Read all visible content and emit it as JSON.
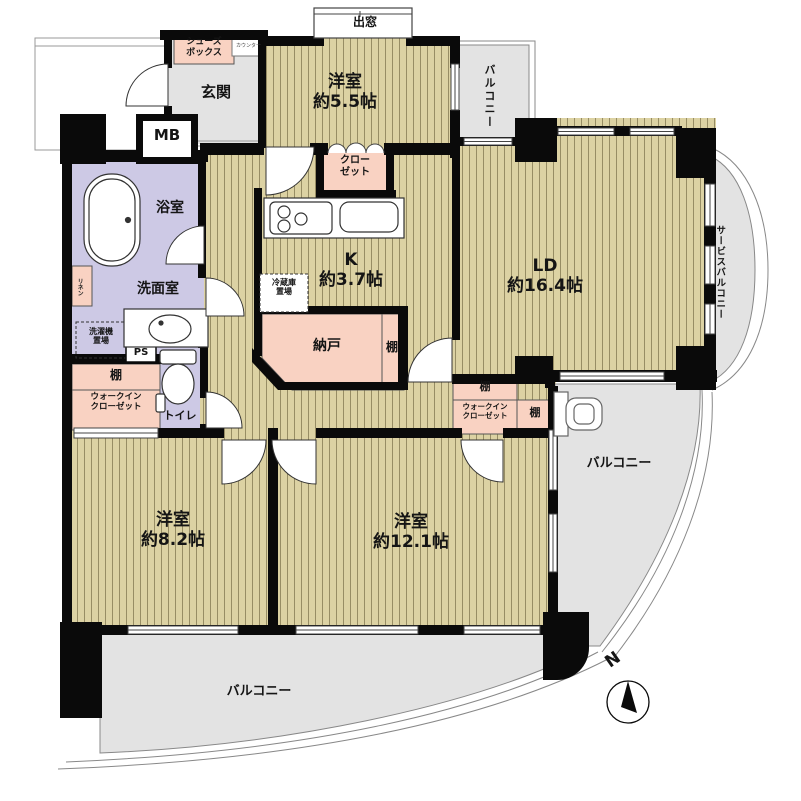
{
  "plan": {
    "title": "マンション間取り図 4LDK",
    "compass": {
      "north_label": "N"
    },
    "palette": {
      "floor": "#dcd2a3",
      "floor_line": "#978d64",
      "wall": "#0a0a0a",
      "wet_room": "#cdc9e5",
      "storage_pink": "#f9d2c2",
      "hard_gray": "#e3e3e3",
      "outline_gray": "#888888"
    },
    "rooms": {
      "entrance": {
        "label": "玄関"
      },
      "shoes_box": {
        "line1": "シューズ",
        "line2": "ボックス"
      },
      "counter": {
        "label": "カウンター"
      },
      "meter_box": {
        "label": "MB"
      },
      "bay_window": {
        "label": "出窓"
      },
      "bedroom_55": {
        "name": "洋室",
        "size": "約5.5帖"
      },
      "balcony_top": {
        "label": "バルコニー"
      },
      "closet": {
        "line1": "クロー",
        "line2": "ゼット"
      },
      "living_dining": {
        "name": "LD",
        "size": "約16.4帖"
      },
      "service_balcony": {
        "label": "サービスバルコニー"
      },
      "kitchen": {
        "name": "K",
        "size": "約3.7帖"
      },
      "fridge_space": {
        "line1": "冷蔵庫",
        "line2": "置場"
      },
      "storage_room": {
        "label": "納戸"
      },
      "storage_shelf": {
        "label": "棚"
      },
      "bathroom": {
        "label": "浴室"
      },
      "linen": {
        "label": "リネン"
      },
      "washroom": {
        "label": "洗面室"
      },
      "laundry_space": {
        "line1": "洗濯機",
        "line2": "置場"
      },
      "pipe_space": {
        "label": "PS"
      },
      "wic_left_shelf": {
        "label": "棚"
      },
      "wic_left": {
        "line1": "ウォークイン",
        "line2": "クローゼット"
      },
      "toilet": {
        "label": "トイレ"
      },
      "bedroom_82": {
        "name": "洋室",
        "size": "約8.2帖"
      },
      "bedroom_121": {
        "name": "洋室",
        "size": "約12.1帖"
      },
      "wic_right_shelf_top": {
        "label": "棚"
      },
      "wic_right": {
        "line1": "ウォークイン",
        "line2": "クローゼット"
      },
      "wic_right_shelf_side": {
        "label": "棚"
      },
      "balcony_right": {
        "label": "バルコニー"
      },
      "balcony_bottom": {
        "label": "バルコニー"
      }
    }
  }
}
